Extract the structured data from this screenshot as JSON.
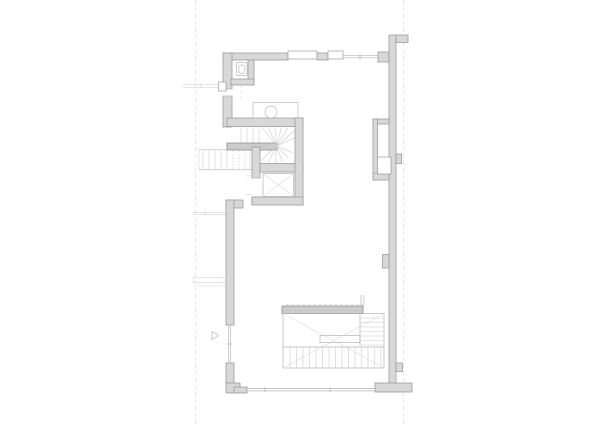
{
  "meta": {
    "drawing_type": "architectural floor plan (line drawing, no labels)",
    "visible_text": "none"
  },
  "canvas": {
    "width": 600,
    "height": 424,
    "background": "#ffffff"
  },
  "palette": {
    "background": "#ffffff",
    "wall_fill": "#d8d8d8",
    "wall_stroke": "#9c9c9c",
    "bar_fill": "#cccccc",
    "bar_stroke": "#8f8f8f",
    "thin_line": "#b4b4b4",
    "fixture_line": "#b9b9b9",
    "tread_line": "#c9c9c9",
    "faint_line": "#d2d2d2",
    "guide_line": "#dcdcdc",
    "xline": "#dadada"
  },
  "elements": [
    {
      "name": "guide-line-left",
      "kind": "dashed-reference-line"
    },
    {
      "name": "guide-line-right",
      "kind": "dashed-reference-line"
    },
    {
      "name": "top-exterior-wall",
      "kind": "wall-with-windows"
    },
    {
      "name": "window-lintel-1",
      "kind": "window"
    },
    {
      "name": "window-lintel-2",
      "kind": "window"
    },
    {
      "name": "top-glazing",
      "kind": "glazing-line"
    },
    {
      "name": "left-exterior-wall",
      "kind": "wall"
    },
    {
      "name": "left-upper-window",
      "kind": "window"
    },
    {
      "name": "wc-room",
      "kind": "small-room"
    },
    {
      "name": "wc-fixture",
      "kind": "toilet"
    },
    {
      "name": "sink-counter",
      "kind": "counter"
    },
    {
      "name": "sink-basin",
      "kind": "round-basin"
    },
    {
      "name": "winder-stair",
      "kind": "u-shaped-winder-stair"
    },
    {
      "name": "stair-divider-wall",
      "kind": "wall"
    },
    {
      "name": "elevator-shaft",
      "kind": "elevator-with-x-mark"
    },
    {
      "name": "right-exterior-wall",
      "kind": "wall-with-pilasters"
    },
    {
      "name": "service-niche",
      "kind": "shaft-niche-with-duct"
    },
    {
      "name": "entrance-arrow",
      "kind": "triangle-marker"
    },
    {
      "name": "left-lower-window",
      "kind": "glazing-line"
    },
    {
      "name": "stair-void",
      "kind": "floor-opening-x-marked"
    },
    {
      "name": "main-stair",
      "kind": "l-shaped-stair"
    },
    {
      "name": "bottom-glazing",
      "kind": "glazing-line"
    },
    {
      "name": "bottom-right-footing",
      "kind": "wall"
    },
    {
      "name": "bottom-left-corner-foot",
      "kind": "wall"
    },
    {
      "name": "neighbor-context-lines",
      "kind": "faint-adjacent-structure"
    }
  ]
}
